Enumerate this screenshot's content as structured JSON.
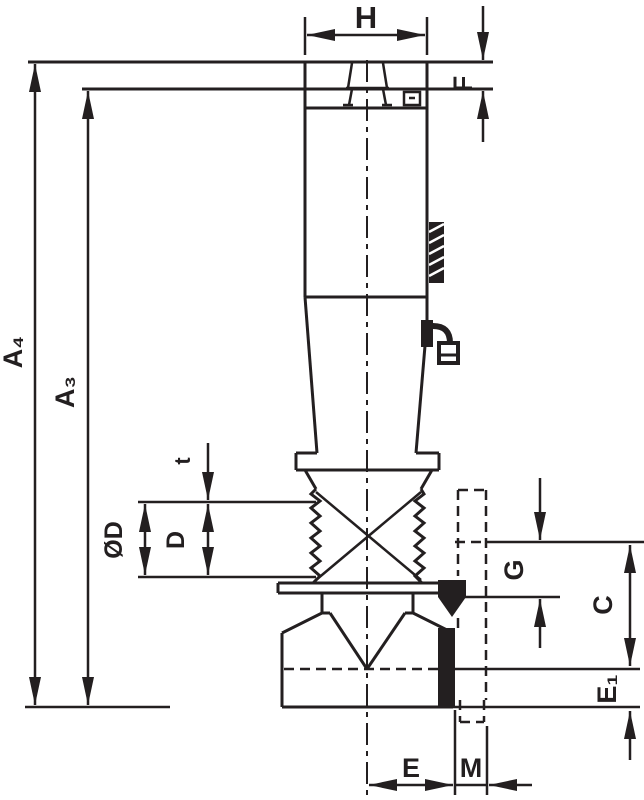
{
  "drawing": {
    "type": "technical-dimension-drawing",
    "line_color": "#231f20",
    "background": "#ffffff",
    "labels": {
      "h": "H",
      "f": "F",
      "a4": "A₄",
      "a3": "A₃",
      "t": "t",
      "od": "ØD",
      "d": "D",
      "g": "G",
      "c": "C",
      "e1": "E₁",
      "e": "E",
      "m": "M"
    }
  }
}
